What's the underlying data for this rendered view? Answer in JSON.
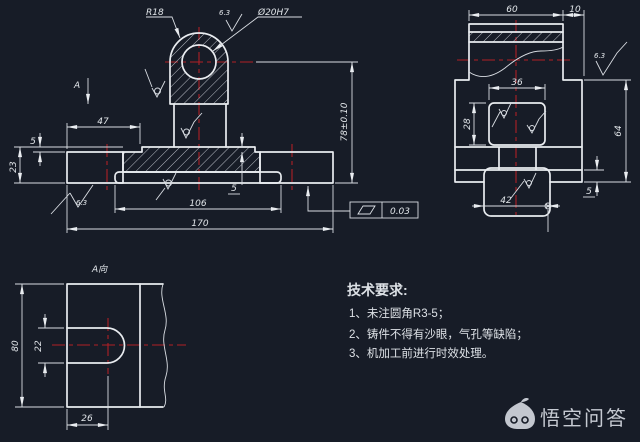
{
  "colors": {
    "background": "#171c27",
    "line": "#e9ecf0",
    "centerline": "#b01f26",
    "text": "#e2e6ea",
    "watermark": "#c6cad2"
  },
  "front_view": {
    "section_label": "A",
    "dims": {
      "radius": "R18",
      "hole": "Ø20H7",
      "roughness_top": "6.3",
      "width_47": "47",
      "height_5_left": "5",
      "height_23": "23",
      "length_106": "106",
      "length_170": "170",
      "height_5_right": "5",
      "height_78": "78±0.10",
      "roughness_left": "6.3"
    }
  },
  "side_view": {
    "dims": {
      "width_60": "60",
      "width_10": "10",
      "width_36": "36",
      "height_28": "28",
      "height_64": "64",
      "height_5": "5",
      "width_42": "42",
      "roughness": "6.3"
    }
  },
  "a_view": {
    "title": "A向",
    "dims": {
      "height_80": "80",
      "height_22": "22",
      "width_26": "26"
    }
  },
  "tolerance_frame": {
    "symbol": "flatness",
    "value": "0.03"
  },
  "tech_requirements": {
    "title": "技术要求:",
    "items": [
      "1、未注圆角R3-5；",
      "2、铸件不得有沙眼，气孔等缺陷；",
      "3、机加工前进行时效处理。"
    ]
  },
  "watermark": {
    "label": "悟空问答",
    "icon": "wukong-monkey-icon"
  }
}
